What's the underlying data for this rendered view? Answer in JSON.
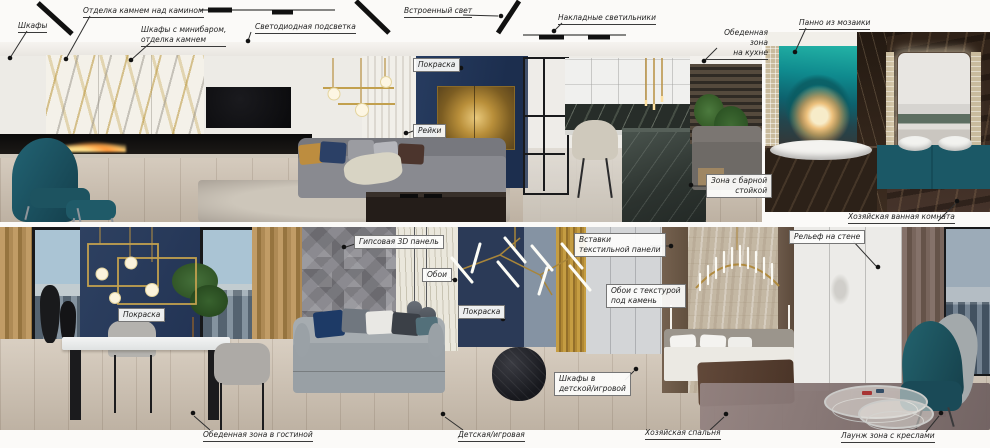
{
  "board": {
    "type": "interior-design-moodboard",
    "rooms": [
      "Гостиная и кухня",
      "Хозяйская ванная комната",
      "Обеденная зона в гостиной",
      "Детская/игровая",
      "Хозяйская спальня",
      "Лаунж зона с креслами"
    ]
  },
  "colors": {
    "accent_navy": "#2b3d5d",
    "accent_teal": "#1d5c6b",
    "accent_gold": "#c2a04e",
    "marble_dark": "#39291f",
    "leader_line": "#2f2f2f"
  },
  "callouts": {
    "cabinets": {
      "label": "Шкафы"
    },
    "stone_fireplace": {
      "label": "Отделка камнем над камином"
    },
    "minibar": {
      "label": "Шкафы с минибаром,\nотделка камнем"
    },
    "led": {
      "label": "Светодиодная подсветка"
    },
    "recessed": {
      "label": "Встроенный свет"
    },
    "surface_lights": {
      "label": "Накладные светильники"
    },
    "kitchen_zone": {
      "label": "Обеденная зона\nна кухне"
    },
    "mosaic": {
      "label": "Панно из мозаики"
    },
    "paint_living": {
      "label": "Покраска"
    },
    "slats": {
      "label": "Рейки"
    },
    "bar_zone": {
      "label": "Зона с барной\nстойкой"
    },
    "master_bath": {
      "label": "Хозяйская ванная комната"
    },
    "gypsum": {
      "label": "Гипсовая 3D панель"
    },
    "wallpaper": {
      "label": "Обои"
    },
    "paint_kids": {
      "label": "Покраска"
    },
    "textile": {
      "label": "Вставки\nтекстильной панели"
    },
    "stone_wallpaper": {
      "label": "Обои с текстурой\nпод камень"
    },
    "relief": {
      "label": "Рельеф на стене"
    },
    "kids_cabinets": {
      "label": "Шкафы в\nдетской/игровой"
    },
    "dining_living": {
      "label": "Обеденная зона в гостиной"
    },
    "kids_room": {
      "label": "Детская/игровая"
    },
    "master_bedroom": {
      "label": "Хозяйская спальня"
    },
    "lounge": {
      "label": "Лаунж зона с креслами"
    },
    "paint_dining": {
      "label": "Покраска"
    }
  }
}
